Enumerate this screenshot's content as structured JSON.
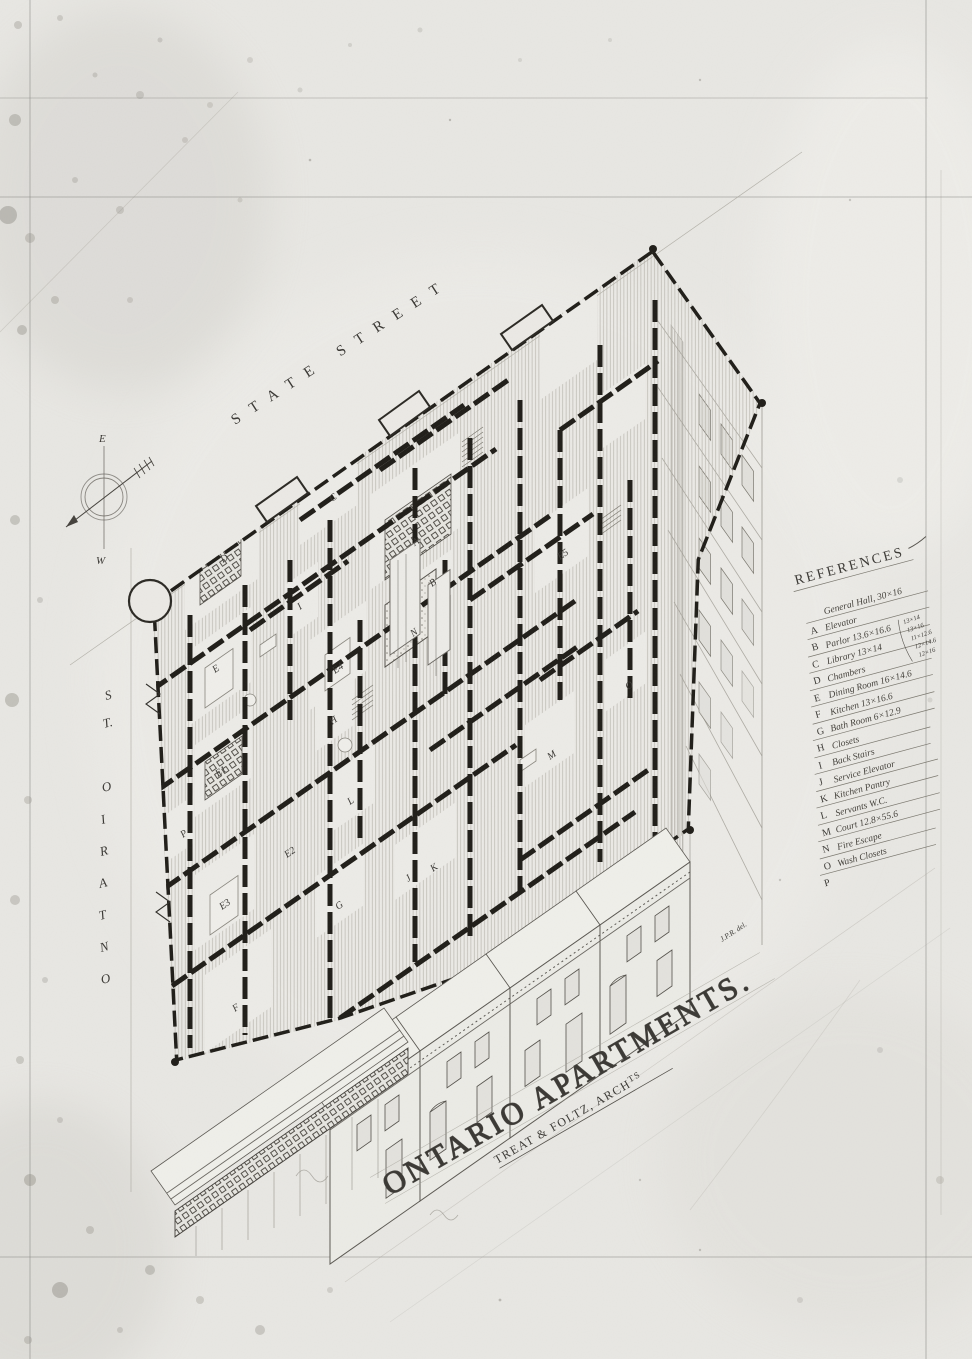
{
  "palette": {
    "paper": "#e9e8e4",
    "ink": "#211f1a",
    "line": "#6b6862"
  },
  "sheet": {
    "title": "ONTARIO  APARTMENTS.",
    "architect": "TREAT & FOLTZ, ARCH",
    "architect_sup": "TS",
    "signature": "J.P.R. del."
  },
  "streets": {
    "top": "STATE   STREET",
    "left": "ONTARIO ST.",
    "left_glyphs": [
      "S",
      "T.",
      "O",
      "I",
      "R",
      "A",
      "T",
      "N",
      "O"
    ]
  },
  "compass": {
    "east": "E",
    "west": "W"
  },
  "references": {
    "title": "REFERENCES",
    "items": [
      {
        "letter": "A",
        "label": "General Hall, 30×16"
      },
      {
        "letter": "B",
        "label": "Elevator"
      },
      {
        "letter": "C",
        "label": "Parlor  13.6×16.6"
      },
      {
        "letter": "D",
        "label": "Library  13×14"
      },
      {
        "letter": "E",
        "label": "Chambers"
      },
      {
        "letter": "F",
        "label": "Dining Room  16×14.6"
      },
      {
        "letter": "G",
        "label": "Kitchen  13×16.6"
      },
      {
        "letter": "H",
        "label": "Bath Room  6×12.9"
      },
      {
        "letter": "I",
        "label": "Closets"
      },
      {
        "letter": "J",
        "label": "Back Stairs"
      },
      {
        "letter": "K",
        "label": "Service Elevator"
      },
      {
        "letter": "L",
        "label": "Kitchen Pantry"
      },
      {
        "letter": "M",
        "label": "Servants W.C."
      },
      {
        "letter": "N",
        "label": "Court  12.8×55.6"
      },
      {
        "letter": "O",
        "label": "Fire Escape"
      },
      {
        "letter": "P",
        "label": "Wash Closets"
      }
    ],
    "chamber_note": [
      "13×14",
      "13×16",
      "11×12.6",
      "12×14.6",
      "12×16"
    ]
  },
  "plan": {
    "room_labels": [
      "D",
      "C",
      "A",
      "B",
      "I",
      "N",
      "E",
      "E4",
      "H",
      "E1",
      "L",
      "M",
      "J",
      "K",
      "E3",
      "G",
      "F",
      "E5",
      "O",
      "P",
      "E2"
    ]
  }
}
